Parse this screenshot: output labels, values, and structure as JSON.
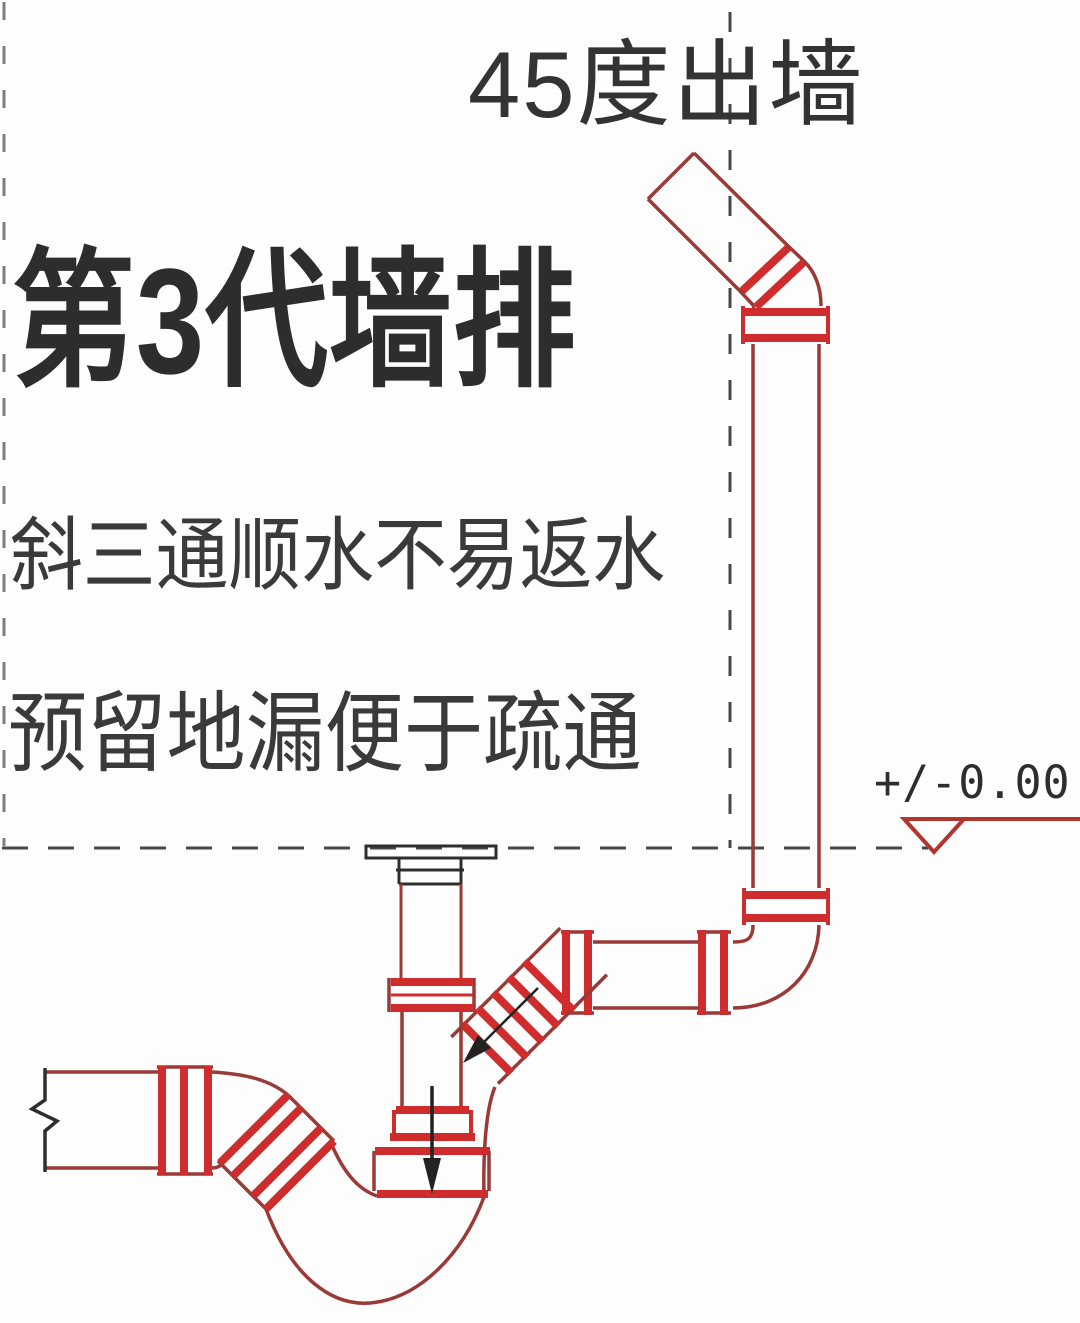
{
  "diagram": {
    "banner_label": "45度出墙",
    "headline": "第3代墙排",
    "note_1": "斜三通顺水不易返水",
    "note_2": "预留地漏便于疏通",
    "elevation_label": "+/-0.00"
  },
  "colors": {
    "bg": "#fdfdfd",
    "text_color": "#333333",
    "pipe_outline": "#9a3a36",
    "pipe_band": "#cf2d2d",
    "drain_black": "#2e2e2e",
    "dash_color": "#474747",
    "elevation_red": "#b23530"
  }
}
